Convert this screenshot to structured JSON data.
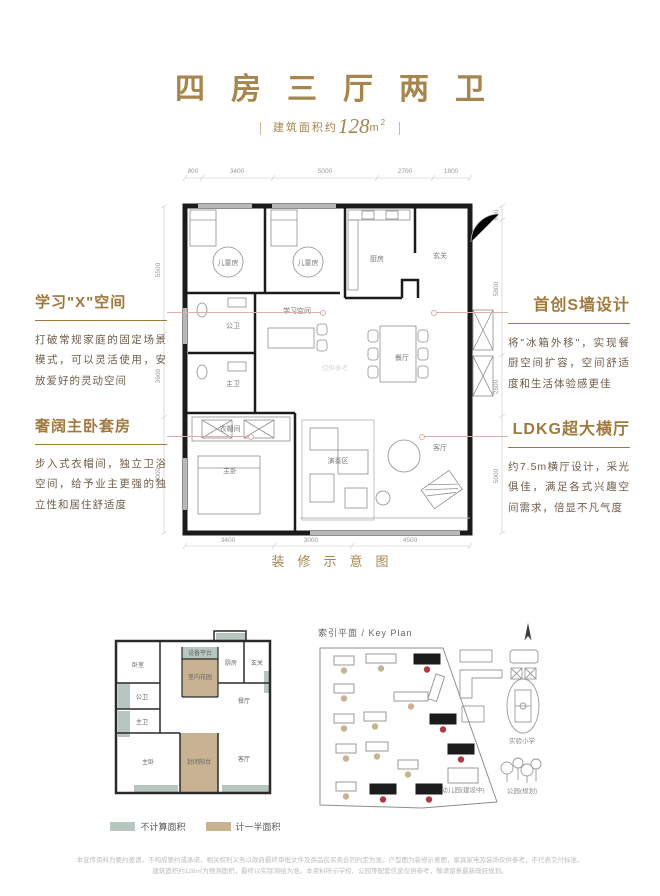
{
  "colors": {
    "gold": "#a6854f",
    "heading": "#a0793f",
    "body-text": "#6e5d4b",
    "leader": "#dcb0a8",
    "green": "#b7c6bf",
    "tan": "#c9b291",
    "red": "#ae3b43",
    "wall": "#1b1b1b",
    "dim": "#9a9a9a",
    "watermark": "#dcdad6"
  },
  "header": {
    "title": "四房三厅两卫",
    "area_prefix": "建筑面积约",
    "area_value": "128",
    "area_unit": "m",
    "area_sup": "2"
  },
  "annotations": {
    "left": [
      {
        "heading": "学习\"X\"空间",
        "body": "打破常规家庭的固定场景模式，可以灵活使用，安放爱好的灵动空间"
      },
      {
        "heading": "奢阔主卧套房",
        "body": "步入式衣帽间，独立卫浴空间，给予业主更强的独立性和居住舒适度"
      }
    ],
    "right": [
      {
        "heading": "首创S墙设计",
        "body": "将\"冰箱外移\"，实现餐厨空间扩容，空间舒适度和生活体验感更佳"
      },
      {
        "heading": "LDKG超大横厅",
        "body": "约7.5m横厅设计，采光俱佳，满足各式兴趣空间需求，倍显不凡气度"
      }
    ]
  },
  "floorplan": {
    "caption": "装修示意图",
    "watermark": "仅供参考",
    "rooms": [
      "儿童房",
      "儿童房",
      "厨房",
      "玄关",
      "公卫",
      "学习空间",
      "主卫",
      "餐厅",
      "衣帽间",
      "主卧",
      "演奏区",
      "客厅"
    ],
    "dims": {
      "top": [
        "800",
        "3400",
        "5000",
        "2700",
        "1800"
      ],
      "bottom": [
        "3400",
        "3000",
        "4500"
      ],
      "left": [
        "5500",
        "3600",
        "5000"
      ],
      "right": [
        "600",
        "5800",
        "2600",
        "5000"
      ]
    }
  },
  "small_plan": {
    "rooms": [
      "卧室",
      "设备平台",
      "室内花园",
      "厨房",
      "玄关",
      "公卫",
      "主卫",
      "餐厅",
      "主卧",
      "封闭阳台",
      "客厅"
    ],
    "legend": [
      {
        "label": "不计算面积"
      },
      {
        "label": "计一半面积"
      }
    ]
  },
  "keyplan": {
    "title": "索引平面 / Key Plan",
    "labels": {
      "school": "实验小学",
      "kindergarten": "幼儿园(建设中)",
      "park": "公园(规划)"
    },
    "buildings": [
      {
        "x": 24,
        "y": 16,
        "w": 20,
        "h": 9
      },
      {
        "x": 56,
        "y": 14,
        "w": 30,
        "h": 9
      },
      {
        "x": 104,
        "y": 14,
        "w": 26,
        "h": 10,
        "dark": true
      },
      {
        "x": 24,
        "y": 44,
        "w": 20,
        "h": 9
      },
      {
        "x": 84,
        "y": 52,
        "w": 34,
        "h": 9
      },
      {
        "x": 24,
        "y": 74,
        "w": 20,
        "h": 9
      },
      {
        "x": 54,
        "y": 72,
        "w": 22,
        "h": 9
      },
      {
        "x": 120,
        "y": 74,
        "w": 26,
        "h": 10,
        "dark": true
      },
      {
        "x": 26,
        "y": 104,
        "w": 20,
        "h": 9
      },
      {
        "x": 56,
        "y": 102,
        "w": 22,
        "h": 9
      },
      {
        "x": 88,
        "y": 120,
        "w": 20,
        "h": 9
      },
      {
        "x": 138,
        "y": 104,
        "w": 26,
        "h": 10,
        "dark": true
      },
      {
        "x": 26,
        "y": 142,
        "w": 20,
        "h": 9
      },
      {
        "x": 60,
        "y": 144,
        "w": 26,
        "h": 10,
        "dark": true
      },
      {
        "x": 106,
        "y": 144,
        "w": 26,
        "h": 10,
        "dark": true
      },
      {
        "x": 126,
        "y": 34,
        "w": 9,
        "h": 26,
        "nodot": true,
        "rot": 18
      },
      {
        "x": 138,
        "y": 128,
        "w": 30,
        "h": 15,
        "nodot": true
      }
    ]
  },
  "footer": {
    "disclaimer_line1": "本宣传资料为要约邀请，不构成要约或承诺，相关权利义务以政府最终审批文件及商品房买卖合同约定为准。户型图为装修示意图，家具家电及装饰仅供参考，不代表交付标准。",
    "disclaimer_line2": "建筑面积约128㎡为预测面积，最终以实际测绘为准。本资料所示学校、公园等配套信息仅供参考，敬请留意最新政府规划。"
  }
}
